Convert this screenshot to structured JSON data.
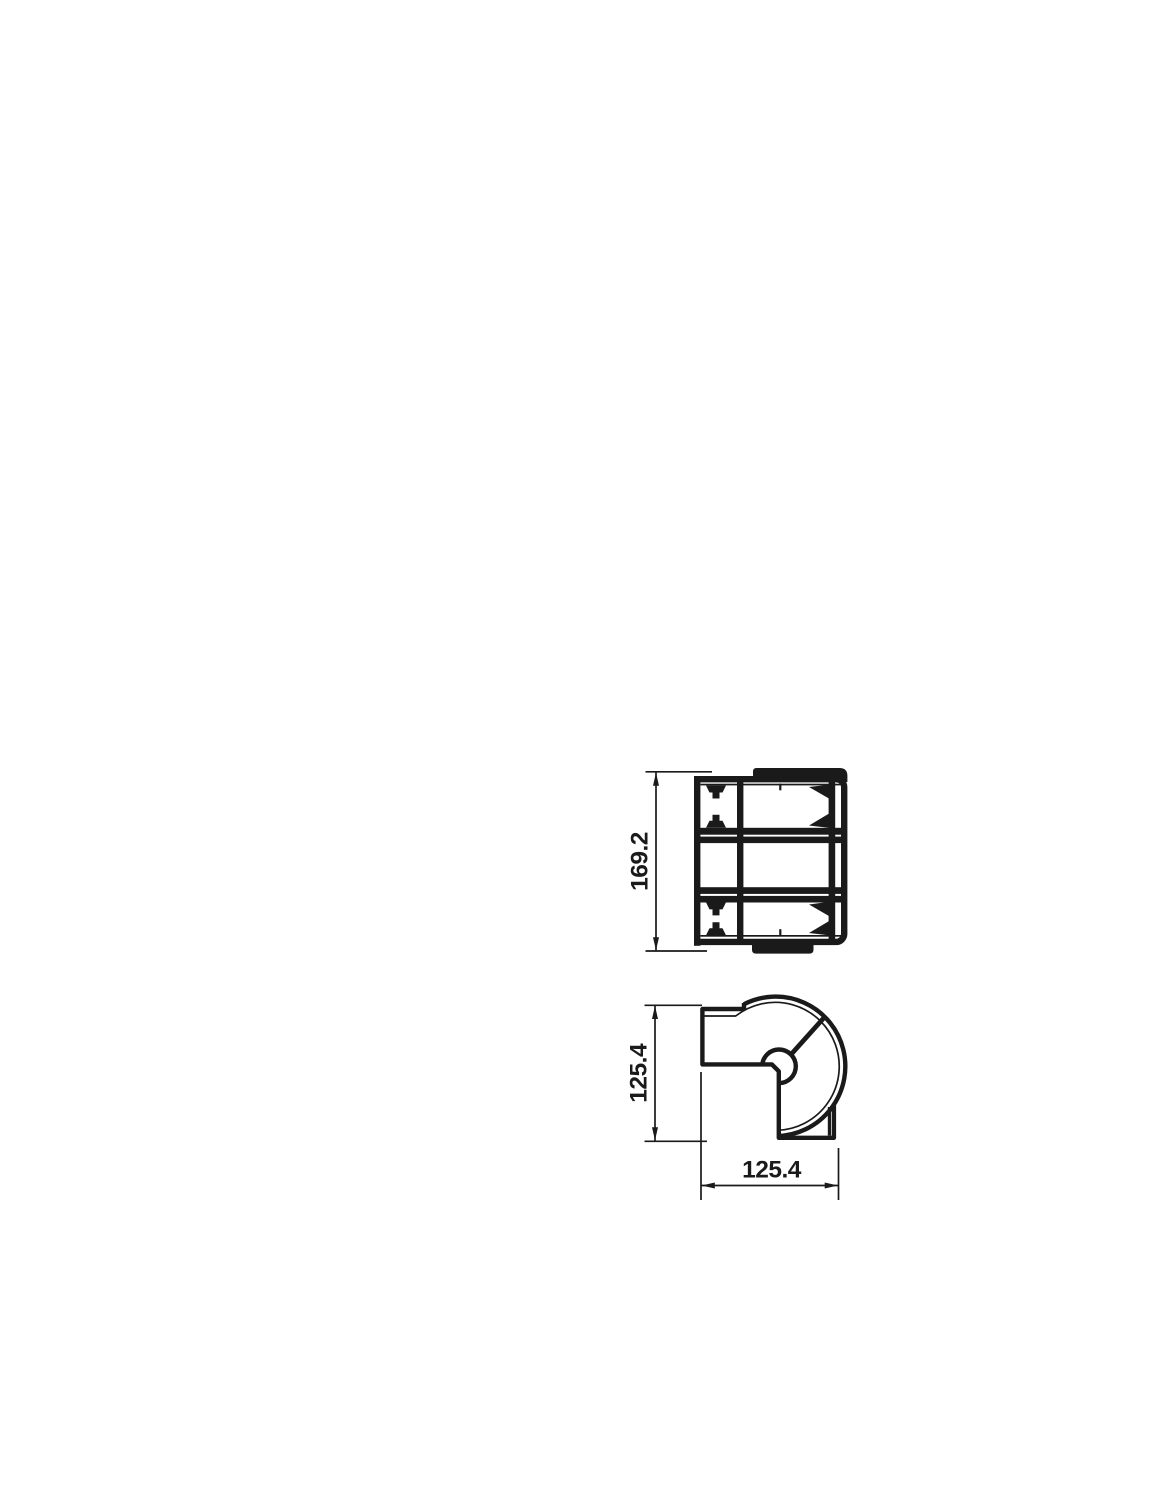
{
  "style": {
    "background": "#ffffff",
    "ink_color": "#1a1a1a"
  },
  "drawing": {
    "dimensions": {
      "profile_height": {
        "value": "169.2",
        "orientation": "vertical",
        "view": "top-view"
      },
      "corner_height": {
        "value": "125.4",
        "orientation": "vertical",
        "view": "bottom-view"
      },
      "corner_width": {
        "value": "125.4",
        "orientation": "horizontal",
        "view": "bottom-view"
      }
    }
  }
}
